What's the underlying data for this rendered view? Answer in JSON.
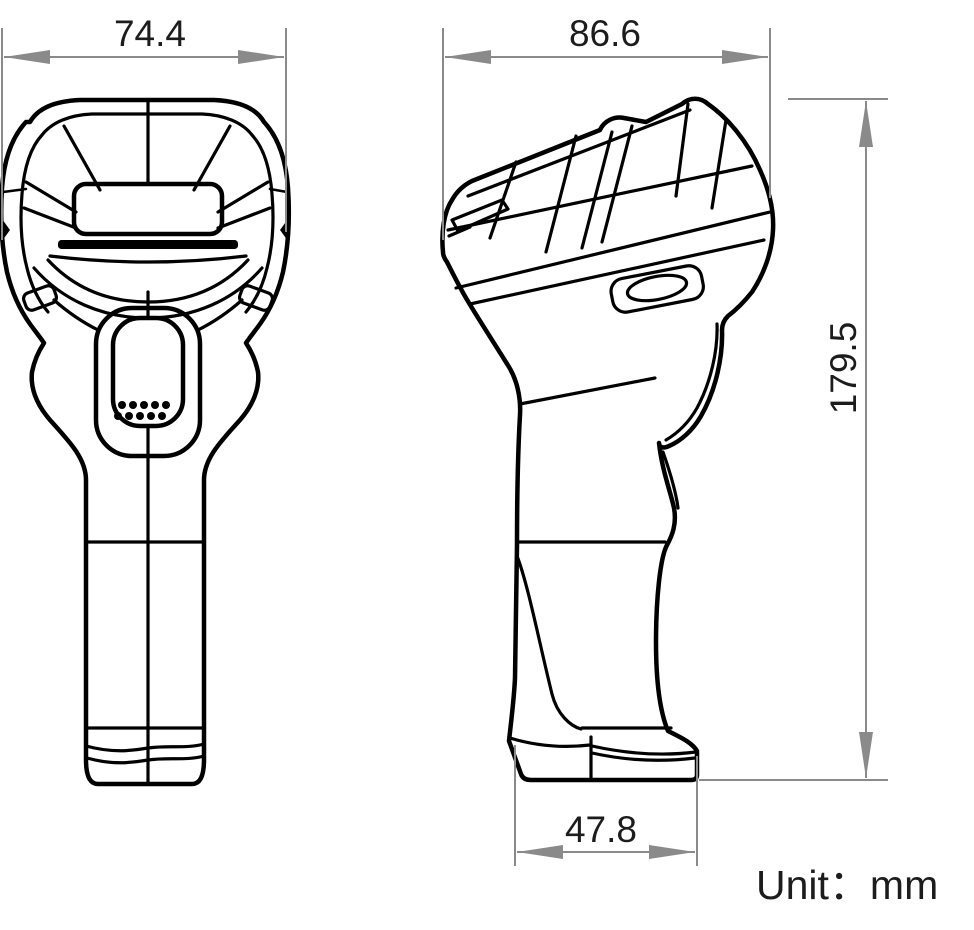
{
  "dimensions": {
    "front_width": "74.4",
    "side_depth": "86.6",
    "overall_height": "179.5",
    "base_depth": "47.8"
  },
  "unit": {
    "label": "Unit：mm"
  },
  "colors": {
    "drawing_line": "#000000",
    "dimension_line": "#8a8a8a",
    "dimension_text": "#1c1c1c",
    "background": "#ffffff"
  }
}
